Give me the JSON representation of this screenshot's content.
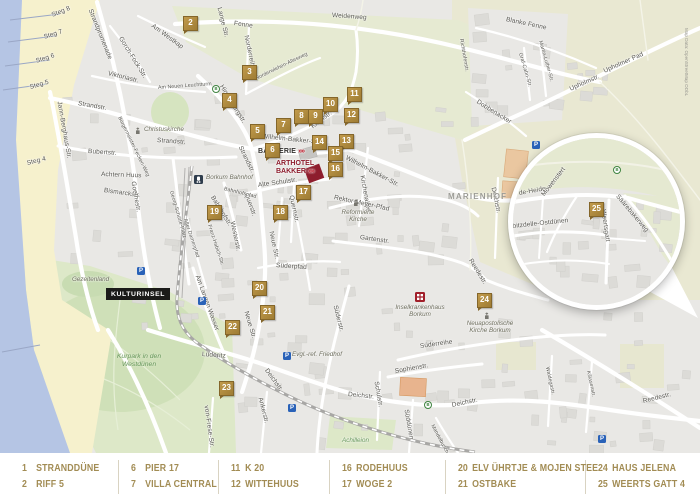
{
  "colors": {
    "marker_gold": "#ad873f",
    "legend_text": "#a28c54",
    "water": "#b5c5e4",
    "beach": "#f6f1cd",
    "field_green": "#e6ead2",
    "park_green": "#dde8c8",
    "urban": "#e9e8e5",
    "arthotel_red": "#8e1d2d",
    "parking_blue": "#2a62b8",
    "bus_green": "#3f8440",
    "hospital_red": "#a11f2a"
  },
  "legend": {
    "groups": [
      [
        {
          "num": "1",
          "label": "STRANDDÜNE"
        },
        {
          "num": "2",
          "label": "RIFF 5"
        }
      ],
      [
        {
          "num": "6",
          "label": "PIER 17"
        },
        {
          "num": "7",
          "label": "VILLA CENTRAL"
        }
      ],
      [
        {
          "num": "11",
          "label": "K 20"
        },
        {
          "num": "12",
          "label": "WITTEHUUS"
        }
      ],
      [
        {
          "num": "16",
          "label": "RODEHUUS"
        },
        {
          "num": "17",
          "label": "WOGE 2"
        }
      ],
      [
        {
          "num": "20",
          "label": "ELV ÜHRTJE & MOJEN STEE"
        },
        {
          "num": "21",
          "label": "OSTBAKE"
        }
      ],
      [
        {
          "num": "24",
          "label": "HAUS JELENA"
        },
        {
          "num": "25",
          "label": "WEERTS GATT 4"
        }
      ]
    ]
  },
  "map": {
    "attribution": "Map Data: OpenStreetMap ODbL",
    "badge": "KULTURINSEL",
    "landmark": {
      "bakkerie": "BAKKERIE",
      "arthotel_l1": "ARTHOTEL",
      "arthotel_l2": "BAKKER",
      "arrow": "»»"
    },
    "markers": [
      {
        "n": "2",
        "x": 183,
        "y": 16
      },
      {
        "n": "3",
        "x": 242,
        "y": 65
      },
      {
        "n": "4",
        "x": 222,
        "y": 93
      },
      {
        "n": "5",
        "x": 250,
        "y": 124
      },
      {
        "n": "6",
        "x": 265,
        "y": 143
      },
      {
        "n": "7",
        "x": 276,
        "y": 118
      },
      {
        "n": "8",
        "x": 294,
        "y": 109
      },
      {
        "n": "9",
        "x": 308,
        "y": 109
      },
      {
        "n": "10",
        "x": 323,
        "y": 97
      },
      {
        "n": "11",
        "x": 347,
        "y": 87
      },
      {
        "n": "12",
        "x": 344,
        "y": 108
      },
      {
        "n": "13",
        "x": 339,
        "y": 134
      },
      {
        "n": "14",
        "x": 312,
        "y": 135
      },
      {
        "n": "15",
        "x": 328,
        "y": 146
      },
      {
        "n": "16",
        "x": 328,
        "y": 162
      },
      {
        "n": "17",
        "x": 296,
        "y": 185
      },
      {
        "n": "18",
        "x": 273,
        "y": 205
      },
      {
        "n": "19",
        "x": 207,
        "y": 205
      },
      {
        "n": "20",
        "x": 252,
        "y": 281
      },
      {
        "n": "21",
        "x": 260,
        "y": 305
      },
      {
        "n": "22",
        "x": 225,
        "y": 320
      },
      {
        "n": "23",
        "x": 219,
        "y": 381
      },
      {
        "n": "24",
        "x": 477,
        "y": 293
      },
      {
        "n": "25",
        "x": 76,
        "y": 64,
        "inset": true
      }
    ],
    "street_labels": [
      {
        "t": "Weidenweg",
        "x": 332,
        "y": 12,
        "r": 4
      },
      {
        "t": "Steg 8",
        "x": 52,
        "y": 12,
        "r": -22
      },
      {
        "t": "Steg 7",
        "x": 44,
        "y": 34,
        "r": -18
      },
      {
        "t": "Steg 6",
        "x": 36,
        "y": 58,
        "r": -18
      },
      {
        "t": "Steg 5",
        "x": 30,
        "y": 84,
        "r": -16
      },
      {
        "t": "Steg 4",
        "x": 27,
        "y": 160,
        "r": -14
      },
      {
        "t": "Strandpromenade",
        "x": 90,
        "y": 6,
        "r": 68
      },
      {
        "t": "Gorch-Fock-Str.",
        "x": 120,
        "y": 34,
        "r": 58
      },
      {
        "t": "Am Westkap",
        "x": 152,
        "y": 22,
        "r": 36
      },
      {
        "t": "Lange Str.",
        "x": 219,
        "y": 4,
        "r": 76
      },
      {
        "t": "Fenne",
        "x": 234,
        "y": 20,
        "r": 8
      },
      {
        "t": "Norderreihe",
        "x": 246,
        "y": 32,
        "r": 78
      },
      {
        "t": "Norderwiehen-Altesweg",
        "x": 256,
        "y": 76,
        "r": -26,
        "c": "sm"
      },
      {
        "t": "Blanke Fenne",
        "x": 506,
        "y": 16,
        "r": 12
      },
      {
        "t": "Martin-Luther-Str.",
        "x": 540,
        "y": 38,
        "r": 74,
        "c": "sm"
      },
      {
        "t": "Graf-Cahn-Str.",
        "x": 520,
        "y": 50,
        "r": 74,
        "c": "sm"
      },
      {
        "t": "Richthofenstr.",
        "x": 461,
        "y": 36,
        "r": 80,
        "c": "sm"
      },
      {
        "t": "Upholmstr.",
        "x": 570,
        "y": 86,
        "r": -24
      },
      {
        "t": "Upholmer Pad",
        "x": 604,
        "y": 68,
        "r": -24
      },
      {
        "t": "Dobbenacker",
        "x": 477,
        "y": 98,
        "r": 32
      },
      {
        "t": "Viktoriastr.",
        "x": 108,
        "y": 70,
        "r": 14
      },
      {
        "t": "Am Neuen Leuchtturm",
        "x": 158,
        "y": 85,
        "r": -4,
        "c": "sm"
      },
      {
        "t": "Hindenburgstr.",
        "x": 221,
        "y": 82,
        "r": 58
      },
      {
        "t": "Strandstr.",
        "x": 78,
        "y": 100,
        "r": 10
      },
      {
        "t": "Strandstr.",
        "x": 157,
        "y": 137,
        "r": 4
      },
      {
        "t": "Strandstr.",
        "x": 240,
        "y": 143,
        "r": 64
      },
      {
        "t": "Jann-Berghaus-Str.",
        "x": 59,
        "y": 98,
        "r": 80
      },
      {
        "t": "Bubertstr.",
        "x": 88,
        "y": 148,
        "r": 4
      },
      {
        "t": "Achtern Huus",
        "x": 101,
        "y": 171,
        "r": 2
      },
      {
        "t": "Bismarckstr.",
        "x": 104,
        "y": 187,
        "r": 8
      },
      {
        "t": "Goethestr.",
        "x": 133,
        "y": 178,
        "r": 80
      },
      {
        "t": "Bürgermeister-Fecken-Weg",
        "x": 119,
        "y": 114,
        "r": 64,
        "c": "sm"
      },
      {
        "t": "Kirchstr.",
        "x": 312,
        "y": 124,
        "r": -38
      },
      {
        "t": "Wilhelm-Bakker-Str.",
        "x": 262,
        "y": 133,
        "r": 6
      },
      {
        "t": "Wilhelm-Bakker-Str.",
        "x": 346,
        "y": 154,
        "r": 28
      },
      {
        "t": "Kirchenallee",
        "x": 362,
        "y": 172,
        "r": 80
      },
      {
        "t": "Rektor-Meyer-Pfad",
        "x": 334,
        "y": 194,
        "r": 12
      },
      {
        "t": "Alte Schulstr.",
        "x": 258,
        "y": 182,
        "r": -8
      },
      {
        "t": "Quernstr.",
        "x": 291,
        "y": 192,
        "r": 78
      },
      {
        "t": "Querstr.",
        "x": 246,
        "y": 190,
        "r": 70
      },
      {
        "t": "Bahnhofspfad",
        "x": 224,
        "y": 186,
        "r": 14,
        "c": "sm"
      },
      {
        "t": "Bahnhofstr.",
        "x": 212,
        "y": 193,
        "r": 58
      },
      {
        "t": "Georg-Schütte-Platz",
        "x": 171,
        "y": 188,
        "r": 74,
        "c": "sm"
      },
      {
        "t": "Alter Damenpfad",
        "x": 185,
        "y": 216,
        "r": 72,
        "c": "sm"
      },
      {
        "t": "Franz-Habich-Str.",
        "x": 209,
        "y": 222,
        "r": 72,
        "c": "sm"
      },
      {
        "t": "Westerstr.",
        "x": 232,
        "y": 218,
        "r": 78
      },
      {
        "t": "Neue Str.",
        "x": 271,
        "y": 228,
        "r": 78
      },
      {
        "t": "Süderpfad",
        "x": 276,
        "y": 262,
        "r": 4
      },
      {
        "t": "Am Langen Wasser",
        "x": 197,
        "y": 272,
        "r": 70
      },
      {
        "t": "Neue Str.",
        "x": 246,
        "y": 308,
        "r": 74
      },
      {
        "t": "Lüderitz",
        "x": 202,
        "y": 351,
        "r": 4
      },
      {
        "t": "Gartenstr.",
        "x": 360,
        "y": 234,
        "r": 8
      },
      {
        "t": "Süderstr.",
        "x": 335,
        "y": 302,
        "r": 76
      },
      {
        "t": "Reedestr.",
        "x": 470,
        "y": 256,
        "r": 58
      },
      {
        "t": "Deichstr.",
        "x": 266,
        "y": 366,
        "r": 54
      },
      {
        "t": "Deichstr.",
        "x": 348,
        "y": 391,
        "r": 6
      },
      {
        "t": "Deichstr.",
        "x": 452,
        "y": 402,
        "r": -12
      },
      {
        "t": "Deichstr.",
        "x": 493,
        "y": 184,
        "r": 78
      },
      {
        "t": "Reedestr.",
        "x": 643,
        "y": 398,
        "r": -14
      },
      {
        "t": "Süderreihe",
        "x": 420,
        "y": 343,
        "r": -8
      },
      {
        "t": "Sophienstr.",
        "x": 395,
        "y": 368,
        "r": -10
      },
      {
        "t": "Schulstr.",
        "x": 376,
        "y": 378,
        "r": 80
      },
      {
        "t": "Süddünen",
        "x": 406,
        "y": 406,
        "r": 80
      },
      {
        "t": "Ankerstr.",
        "x": 260,
        "y": 394,
        "r": 76
      },
      {
        "t": "von-Frese-Str.",
        "x": 206,
        "y": 402,
        "r": 82
      },
      {
        "t": "Mandelbusch",
        "x": 432,
        "y": 422,
        "r": 62,
        "c": "sm"
      },
      {
        "t": "Waldegastr.",
        "x": 547,
        "y": 364,
        "r": 78,
        "c": "sm"
      },
      {
        "t": "Killasenstr.",
        "x": 588,
        "y": 368,
        "r": 78,
        "c": "sm"
      },
      {
        "t": "de-Heide",
        "x": 6,
        "y": 52,
        "r": -10,
        "inset": true
      },
      {
        "t": "Möwenstert",
        "x": 30,
        "y": 54,
        "r": -52,
        "inset": true
      },
      {
        "t": "Säärebakerweg",
        "x": 104,
        "y": 54,
        "r": 50,
        "inset": true
      },
      {
        "t": "Kiebitzdelle-Ostdünen",
        "x": -10,
        "y": 86,
        "r": -6,
        "inset": true
      },
      {
        "t": "Weertsgatt",
        "x": 90,
        "y": 68,
        "r": 82,
        "inset": true
      }
    ],
    "poi_labels": [
      {
        "t": "MARIENHOF",
        "x": 448,
        "y": 192,
        "cls": "district"
      },
      {
        "t": "Borkum Bahnhof",
        "x": 206,
        "y": 174,
        "cls": "poi"
      },
      {
        "t": "Christuskirche",
        "x": 144,
        "y": 126,
        "cls": "poi"
      },
      {
        "t": "Reformierte Kirche",
        "x": 332,
        "y": 209,
        "cls": "poi2"
      },
      {
        "t": "Inselkrankenhaus Borkum",
        "x": 394,
        "y": 304,
        "cls": "poi2"
      },
      {
        "t": "Neuapostolische Kirche Borkum",
        "x": 464,
        "y": 320,
        "cls": "poi2"
      },
      {
        "t": "Evgl.-ref. Friedhof",
        "x": 292,
        "y": 351,
        "cls": "poi"
      },
      {
        "t": "Kurpark in den Westdünen",
        "x": 110,
        "y": 353,
        "cls": "park2"
      },
      {
        "t": "Achilleion",
        "x": 342,
        "y": 437,
        "cls": "poi park"
      },
      {
        "t": "Gezeitenland",
        "x": 72,
        "y": 276,
        "cls": "poi"
      }
    ],
    "icons": {
      "parking": [
        [
          137,
          267
        ],
        [
          198,
          297
        ],
        [
          283,
          352
        ],
        [
          288,
          404
        ],
        [
          532,
          141
        ],
        [
          598,
          435
        ]
      ],
      "bus": [
        [
          212,
          85
        ],
        [
          424,
          401
        ]
      ],
      "bus_inset": [
        [
          100,
          28
        ]
      ],
      "train": [
        [
          194,
          175
        ]
      ],
      "church": [
        [
          134,
          127
        ],
        [
          352,
          199
        ],
        [
          483,
          312
        ]
      ],
      "hospital": [
        [
          415,
          292
        ]
      ],
      "bus_letter": "B",
      "parking_letter": "P"
    }
  }
}
